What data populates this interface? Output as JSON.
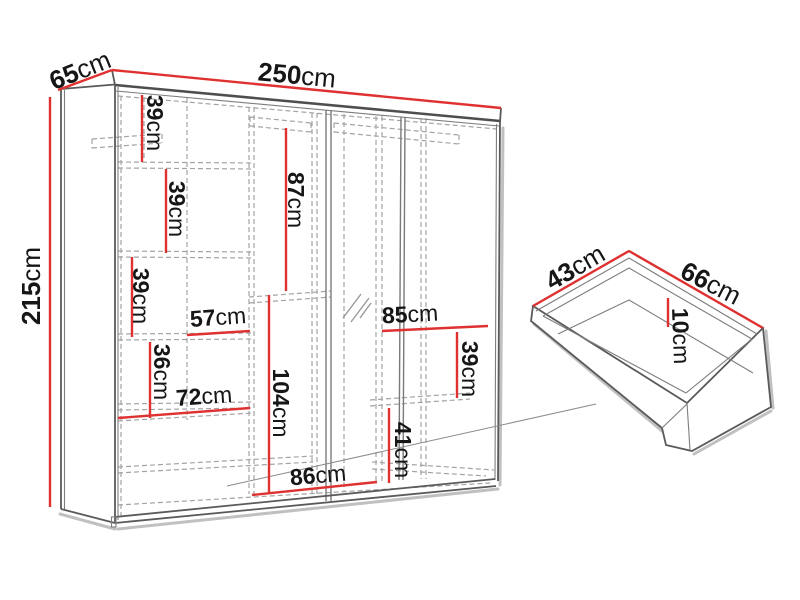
{
  "diagram": {
    "kind": "wardrobe-dimension-diagram",
    "unit": "cm",
    "accent_color": "#e03131",
    "outline_color": "#565656",
    "dashed_color": "#a3a3a3",
    "text_color": "#161616",
    "wardrobe": {
      "width_cm": 250,
      "depth_cm": 65,
      "height_cm": 215,
      "interior_dimensions_cm": [
        39,
        39,
        39,
        87,
        57,
        36,
        72,
        104,
        86,
        85,
        39,
        41
      ]
    },
    "drawer": {
      "depth_cm": 43,
      "width_cm": 66,
      "inner_height_cm": 10
    }
  },
  "labels": [
    {
      "id": "wardrobe-depth",
      "value": "65",
      "unit": "cm"
    },
    {
      "id": "wardrobe-width",
      "value": "250",
      "unit": "cm"
    },
    {
      "id": "wardrobe-height",
      "value": "215",
      "unit": "cm"
    },
    {
      "id": "left-shelf-1-height",
      "value": "39",
      "unit": "cm"
    },
    {
      "id": "left-shelf-2-height",
      "value": "39",
      "unit": "cm"
    },
    {
      "id": "left-shelf-3-height",
      "value": "39",
      "unit": "cm"
    },
    {
      "id": "middle-opening-height",
      "value": "87",
      "unit": "cm"
    },
    {
      "id": "left-shelf-width",
      "value": "57",
      "unit": "cm"
    },
    {
      "id": "left-shelf-4-height",
      "value": "36",
      "unit": "cm"
    },
    {
      "id": "left-section-width",
      "value": "72",
      "unit": "cm"
    },
    {
      "id": "middle-lower-height",
      "value": "104",
      "unit": "cm"
    },
    {
      "id": "middle-bottom-width",
      "value": "86",
      "unit": "cm"
    },
    {
      "id": "right-section-width",
      "value": "85",
      "unit": "cm"
    },
    {
      "id": "right-shelf-height",
      "value": "39",
      "unit": "cm"
    },
    {
      "id": "right-lower-height",
      "value": "41",
      "unit": "cm"
    },
    {
      "id": "drawer-depth",
      "value": "43",
      "unit": "cm"
    },
    {
      "id": "drawer-width",
      "value": "66",
      "unit": "cm"
    },
    {
      "id": "drawer-inner-height",
      "value": "10",
      "unit": "cm"
    }
  ]
}
